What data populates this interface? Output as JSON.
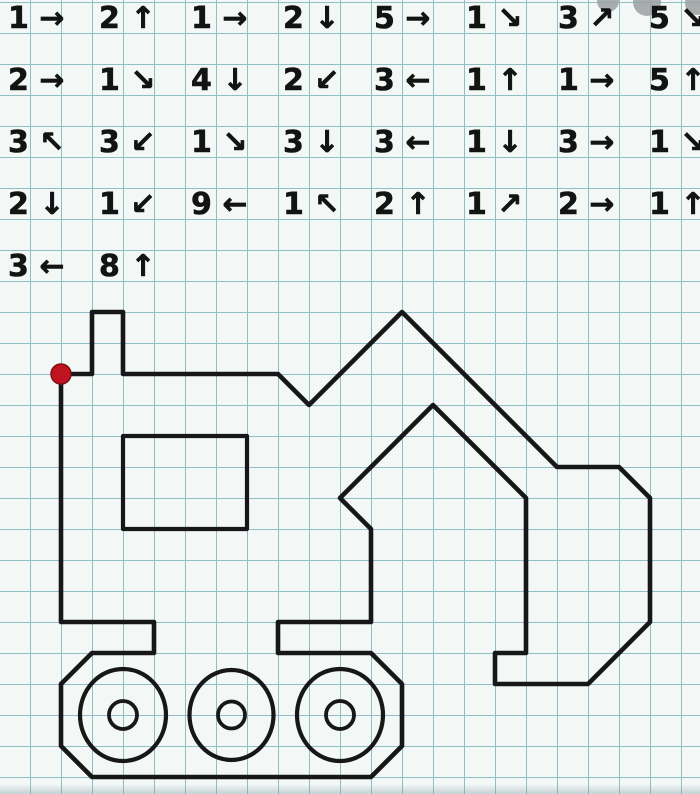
{
  "page": {
    "bg": "#f3f8f7",
    "width": 700,
    "height": 794
  },
  "grid": {
    "cell": 31,
    "line_color": "#8fbec6",
    "offset_x": 30,
    "offset_y": 2
  },
  "start_dot": {
    "x": 61,
    "y": 374,
    "radius": 10,
    "color": "#c01520",
    "edge_color": "#7e0d12"
  },
  "instructions": {
    "ink": "#131313",
    "rows": [
      {
        "items": [
          {
            "count": 1,
            "arrow": "→",
            "label": "1 →"
          },
          {
            "count": 2,
            "arrow": "↑",
            "label": "2 ↑"
          },
          {
            "count": 1,
            "arrow": "→",
            "label": "1 →"
          },
          {
            "count": 2,
            "arrow": "↓",
            "label": "2 ↓"
          },
          {
            "count": 5,
            "arrow": "→",
            "label": "5 →"
          },
          {
            "count": 1,
            "arrow": "↘",
            "label": "1 ↘"
          },
          {
            "count": 3,
            "arrow": "↗",
            "label": "3 ↗"
          },
          {
            "count": 5,
            "arrow": "↘",
            "label": "5 ↘"
          }
        ]
      },
      {
        "items": [
          {
            "count": 2,
            "arrow": "→",
            "label": "2 →"
          },
          {
            "count": 1,
            "arrow": "↘",
            "label": "1 ↘"
          },
          {
            "count": 4,
            "arrow": "↓",
            "label": "4 ↓"
          },
          {
            "count": 2,
            "arrow": "↙",
            "label": "2 ↙"
          },
          {
            "count": 3,
            "arrow": "←",
            "label": "3 ←"
          },
          {
            "count": 1,
            "arrow": "↑",
            "label": "1 ↑"
          },
          {
            "count": 1,
            "arrow": "→",
            "label": "1 →"
          },
          {
            "count": 5,
            "arrow": "↑",
            "label": "5 ↑"
          }
        ]
      },
      {
        "items": [
          {
            "count": 3,
            "arrow": "↖",
            "label": "3 ↖"
          },
          {
            "count": 3,
            "arrow": "↙",
            "label": "3 ↙"
          },
          {
            "count": 1,
            "arrow": "↘",
            "label": "1 ↘"
          },
          {
            "count": 3,
            "arrow": "↓",
            "label": "3 ↓"
          },
          {
            "count": 3,
            "arrow": "←",
            "label": "3 ←"
          },
          {
            "count": 1,
            "arrow": "↓",
            "label": "1 ↓"
          },
          {
            "count": 3,
            "arrow": "→",
            "label": "3 →"
          },
          {
            "count": 1,
            "arrow": "↘",
            "label": "1 ↘"
          }
        ]
      },
      {
        "items": [
          {
            "count": 2,
            "arrow": "↓",
            "label": "2 ↓"
          },
          {
            "count": 1,
            "arrow": "↙",
            "label": "1 ↙"
          },
          {
            "count": 9,
            "arrow": "←",
            "label": "9 ←"
          },
          {
            "count": 1,
            "arrow": "↖",
            "label": "1 ↖"
          },
          {
            "count": 2,
            "arrow": "↑",
            "label": "2 ↑"
          },
          {
            "count": 1,
            "arrow": "↗",
            "label": "1 ↗"
          },
          {
            "count": 2,
            "arrow": "→",
            "label": "2 →"
          },
          {
            "count": 1,
            "arrow": "↑",
            "label": "1 ↑"
          }
        ]
      },
      {
        "items": [
          {
            "count": 3,
            "arrow": "←",
            "label": "3 ←"
          },
          {
            "count": 8,
            "arrow": "↑",
            "label": "8 ↑"
          }
        ]
      }
    ]
  },
  "figure": {
    "ink": "#171717",
    "outline_path": "M61 374L92 374L92 312L123 312L123 374L278 374L309 405L402 312L557 467L619 467L650 498L650 622L588 684L495 684L495 653L526 653L526 498L433 405L340 498L371 529L371 622L278 622L278 653L371 653L402 684L402 746L371 777L92 777L61 746L61 684L92 653L154 653L154 622L61 622Z",
    "window_path": "M123 436h124v93h-124Z",
    "wheels": [
      {
        "cx": 123,
        "cy": 715,
        "rx": 43,
        "ry": 46,
        "hub_r": 14
      },
      {
        "cx": 231.5,
        "cy": 715,
        "rx": 42,
        "ry": 45,
        "hub_r": 13.5
      },
      {
        "cx": 340,
        "cy": 715,
        "rx": 43,
        "ry": 46,
        "hub_r": 14
      }
    ],
    "grid_points": [
      [
        0,
        0
      ],
      [
        1,
        0
      ],
      [
        1,
        -2
      ],
      [
        2,
        -2
      ],
      [
        2,
        0
      ],
      [
        7,
        0
      ],
      [
        8,
        1
      ],
      [
        11,
        -2
      ],
      [
        16,
        3
      ],
      [
        18,
        3
      ],
      [
        19,
        4
      ],
      [
        19,
        8
      ],
      [
        17,
        10
      ],
      [
        14,
        10
      ],
      [
        14,
        9
      ],
      [
        15,
        9
      ],
      [
        15,
        4
      ],
      [
        12,
        1
      ],
      [
        9,
        4
      ],
      [
        10,
        5
      ],
      [
        10,
        8
      ],
      [
        7,
        8
      ],
      [
        7,
        9
      ],
      [
        10,
        9
      ],
      [
        11,
        10
      ],
      [
        11,
        12
      ],
      [
        10,
        13
      ],
      [
        1,
        13
      ],
      [
        0,
        12
      ],
      [
        0,
        10
      ],
      [
        1,
        9
      ],
      [
        3,
        9
      ],
      [
        3,
        8
      ],
      [
        0,
        8
      ],
      [
        0,
        0
      ]
    ]
  },
  "watermark_blobs": [
    {
      "cx": 608,
      "cy": 1,
      "r": 11
    },
    {
      "cx": 647,
      "cy": 2,
      "r": 14
    },
    {
      "cx": 697,
      "cy": 3,
      "r": 12
    }
  ]
}
